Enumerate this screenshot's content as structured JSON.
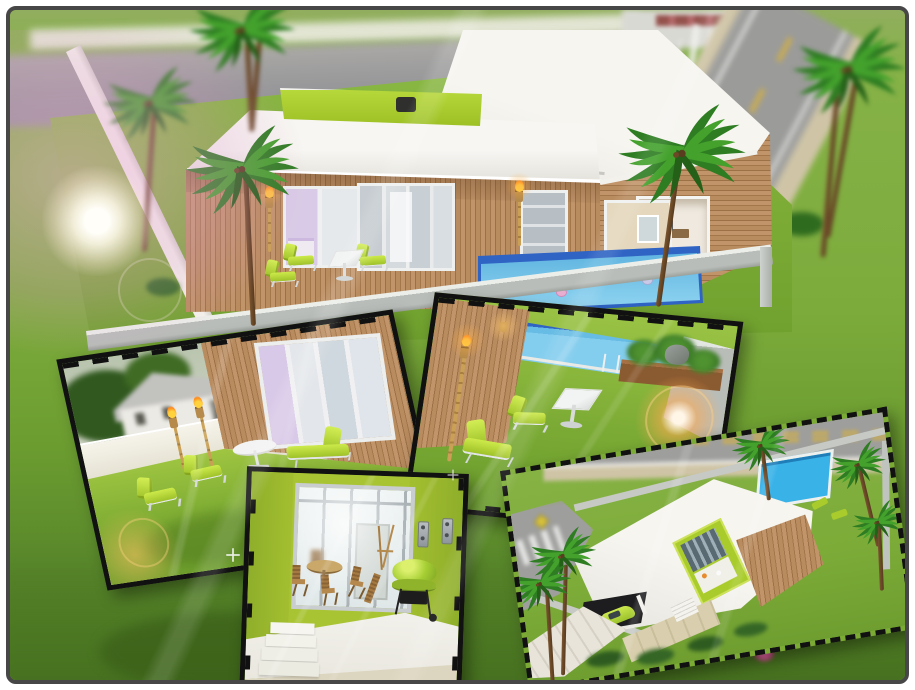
{
  "meta": {
    "canvas": {
      "width": 915,
      "height": 690
    },
    "kind": "game-screenshot-collage"
  },
  "palette": {
    "frame_border": "#474747",
    "border_black": "#111111",
    "lime": "#a9cc2c",
    "lime_dark": "#8fb321",
    "grass_lot": "#7cab35",
    "grass_bg": "#6f9c33",
    "grass_dark": "#4d7a24",
    "wood": "#b4875c",
    "roof_white": "#f3f2ed",
    "roof_shadow": "#d7d5ce",
    "wall_gray": "#bcc0bc",
    "fence_white": "#ecebe1",
    "pool_water": "#7cc6e8",
    "pool_tile": "#2f63c4",
    "pool_bright": "#39b2e8",
    "street_gray": "#9d9d9a",
    "sidewalk": "#cfc4a6",
    "road_yellow": "#d8b23a",
    "flare_pink": "#e9b9d9",
    "flare_warm": "#ffc477",
    "flame_orange": "#ff9b2e",
    "interior_lime": "#a9c433"
  },
  "scene": {
    "main_view": {
      "name": "backyard-overview",
      "elements": [
        "modern-house",
        "flat-white-roof",
        "green-roof-deck",
        "wood-facade",
        "swimming-pool",
        "lime-loungers",
        "glass-table",
        "palm-trees",
        "perimeter-wall",
        "street",
        "lens-flare"
      ]
    },
    "insets": [
      {
        "name": "patio-furniture-closeup"
      },
      {
        "name": "pool-corner-closeup"
      },
      {
        "name": "porch-interior-closeup"
      },
      {
        "name": "front-aerial-view"
      }
    ]
  }
}
